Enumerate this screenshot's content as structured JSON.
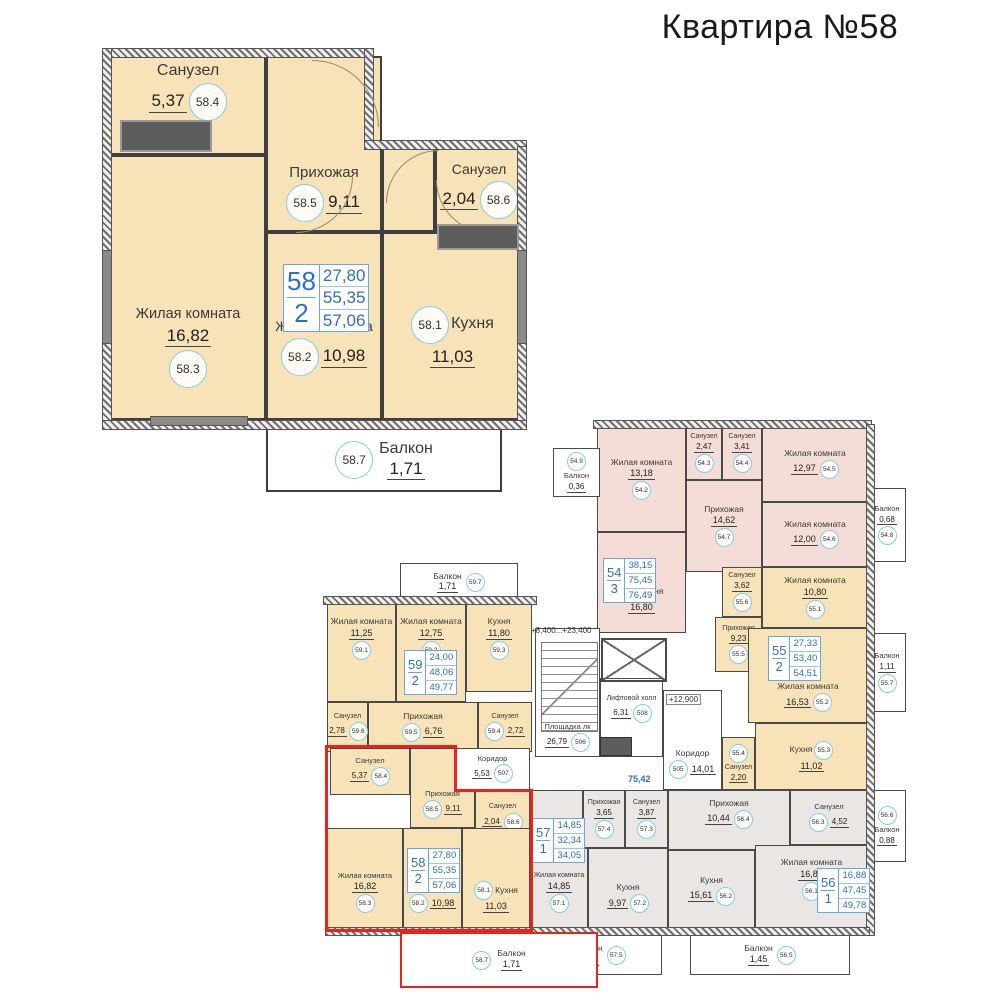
{
  "title": "Квартира №58",
  "detail": {
    "info": {
      "num": "58",
      "rooms": "2",
      "living_area": "27,80",
      "floor_area": "55,35",
      "total_area": "57,06"
    },
    "rooms": {
      "wc1": {
        "id": "58.4",
        "name": "Санузел",
        "area": "5,37"
      },
      "hall": {
        "id": "58.5",
        "name": "Прихожая",
        "area": "9,11"
      },
      "wc2": {
        "id": "58.6",
        "name": "Санузел",
        "area": "2,04"
      },
      "living1": {
        "id": "58.3",
        "name": "Жилая комната",
        "area": "16,82"
      },
      "living2": {
        "id": "58.2",
        "name": "Жилая комната",
        "area": "10,98"
      },
      "kitchen": {
        "id": "58.1",
        "name": "Кухня",
        "area": "11,03"
      },
      "balcony": {
        "id": "58.7",
        "name": "Балкон",
        "area": "1,71"
      }
    }
  },
  "floor": {
    "labels": {
      "elev_stairs": "+8,400...+23,400",
      "elev_corridor": "+12,900",
      "common_total": "75,42"
    },
    "common": {
      "landing": {
        "id": "506",
        "name": "Площадка лк",
        "area": "26,79"
      },
      "lift_hall": {
        "id": "508",
        "name": "Лифтовой холл",
        "area": "6,31"
      },
      "corridor": {
        "id": "505",
        "name": "Коридор",
        "area": "14,01"
      },
      "corridor2": {
        "id": "507",
        "name": "Коридор",
        "area": "5,53"
      }
    },
    "apts": {
      "a54": {
        "info": {
          "num": "54",
          "rooms": "3",
          "living_area": "38,15",
          "floor_area": "75,45",
          "total_area": "76,49"
        },
        "rooms": {
          "kitchen": {
            "id": "54.1",
            "name": "Кухня",
            "area": "16,80"
          },
          "living1": {
            "id": "54.2",
            "name": "Жилая комната",
            "area": "13,18"
          },
          "wc1": {
            "id": "54.3",
            "name": "Санузел",
            "area": "2,47"
          },
          "wc2": {
            "id": "54.4",
            "name": "Санузел",
            "area": "3,41"
          },
          "living2": {
            "id": "54.5",
            "name": "Жилая комната",
            "area": "12,97"
          },
          "living3": {
            "id": "54.6",
            "name": "Жилая комната",
            "area": "12,00"
          },
          "hall": {
            "id": "54.7",
            "name": "Прихожая",
            "area": "14,62"
          },
          "balcony1": {
            "id": "54.8",
            "name": "Балкон",
            "area": "0,68"
          },
          "balcony2": {
            "id": "54.9",
            "name": "Балкон",
            "area": "0,36"
          }
        }
      },
      "a55": {
        "info": {
          "num": "55",
          "rooms": "2",
          "living_area": "27,33",
          "floor_area": "53,40",
          "total_area": "54,51"
        },
        "rooms": {
          "living1": {
            "id": "55.1",
            "name": "Жилая комната",
            "area": "10,80"
          },
          "living2": {
            "id": "55.2",
            "name": "Жилая комната",
            "area": "16,53"
          },
          "kitchen": {
            "id": "55.3",
            "name": "Кухня",
            "area": "11,02"
          },
          "wc1": {
            "id": "55.4",
            "name": "Санузел",
            "area": "2,20"
          },
          "hall": {
            "id": "55.5",
            "name": "Прихожая",
            "area": "9,23"
          },
          "wc2": {
            "id": "55.6",
            "name": "Санузел",
            "area": "3,62"
          },
          "balcony": {
            "id": "55.7",
            "name": "Балкон",
            "area": "1,11"
          }
        }
      },
      "a56": {
        "info": {
          "num": "56",
          "rooms": "1",
          "living_area": "16,88",
          "floor_area": "47,45",
          "total_area": "49,78"
        },
        "rooms": {
          "living": {
            "id": "56.1",
            "name": "Жилая комната",
            "area": "16,88"
          },
          "kitchen": {
            "id": "56.2",
            "name": "Кухня",
            "area": "15,61"
          },
          "wc": {
            "id": "56.3",
            "name": "Санузел",
            "area": "4,52"
          },
          "hall": {
            "id": "56.4",
            "name": "Прихожая",
            "area": "10,44"
          },
          "balcony1": {
            "id": "56.5",
            "name": "Балкон",
            "area": "1,45"
          },
          "balcony2": {
            "id": "56.6",
            "name": "Балкон",
            "area": "0,88"
          }
        }
      },
      "a57": {
        "info": {
          "num": "57",
          "rooms": "1",
          "living_area": "14,85",
          "floor_area": "32,34",
          "total_area": "34,05"
        },
        "rooms": {
          "living": {
            "id": "57.1",
            "name": "Жилая комната",
            "area": "14,85"
          },
          "kitchen": {
            "id": "57.2",
            "name": "Кухня",
            "area": "9,97"
          },
          "wc": {
            "id": "57.3",
            "name": "Санузел",
            "area": "3,87"
          },
          "hall": {
            "id": "57.4",
            "name": "Прихожая",
            "area": "3,65"
          },
          "balcony": {
            "id": "57.5",
            "name": "Балкон",
            "area": "1,71"
          }
        }
      },
      "a58": {
        "info": {
          "num": "58",
          "rooms": "2",
          "living_area": "27,80",
          "floor_area": "55,35",
          "total_area": "57,06"
        },
        "rooms": {
          "kitchen": {
            "id": "58.1",
            "name": "Кухня",
            "area": "11,03"
          },
          "living2": {
            "id": "58.2",
            "name": "Жилая комната",
            "area": "10,98"
          },
          "living1": {
            "id": "58.3",
            "name": "Жилая комната",
            "area": "16,82"
          },
          "wc1": {
            "id": "58.4",
            "name": "Санузел",
            "area": "5,37"
          },
          "hall": {
            "id": "58.5",
            "name": "Прихожая",
            "area": "9,11"
          },
          "wc2": {
            "id": "58.6",
            "name": "Санузел",
            "area": "2,04"
          },
          "balcony": {
            "id": "58.7",
            "name": "Балкон",
            "area": "1,71"
          }
        }
      },
      "a59": {
        "info": {
          "num": "59",
          "rooms": "2",
          "living_area": "24,00",
          "floor_area": "48,06",
          "total_area": "49,77"
        },
        "rooms": {
          "living1": {
            "id": "59.1",
            "name": "Жилая комната",
            "area": "11,25"
          },
          "living2": {
            "id": "59.2",
            "name": "Жилая комната",
            "area": "12,75"
          },
          "kitchen": {
            "id": "59.3",
            "name": "Кухня",
            "area": "11,80"
          },
          "wc2": {
            "id": "59.4",
            "name": "Санузел",
            "area": "2,72"
          },
          "hall": {
            "id": "59.5",
            "name": "Прихожая",
            "area": "6,76"
          },
          "wc1": {
            "id": "59.6",
            "name": "Санузел",
            "area": "2,78"
          },
          "balcony": {
            "id": "59.7",
            "name": "Балкон",
            "area": "1,71"
          }
        }
      }
    }
  }
}
